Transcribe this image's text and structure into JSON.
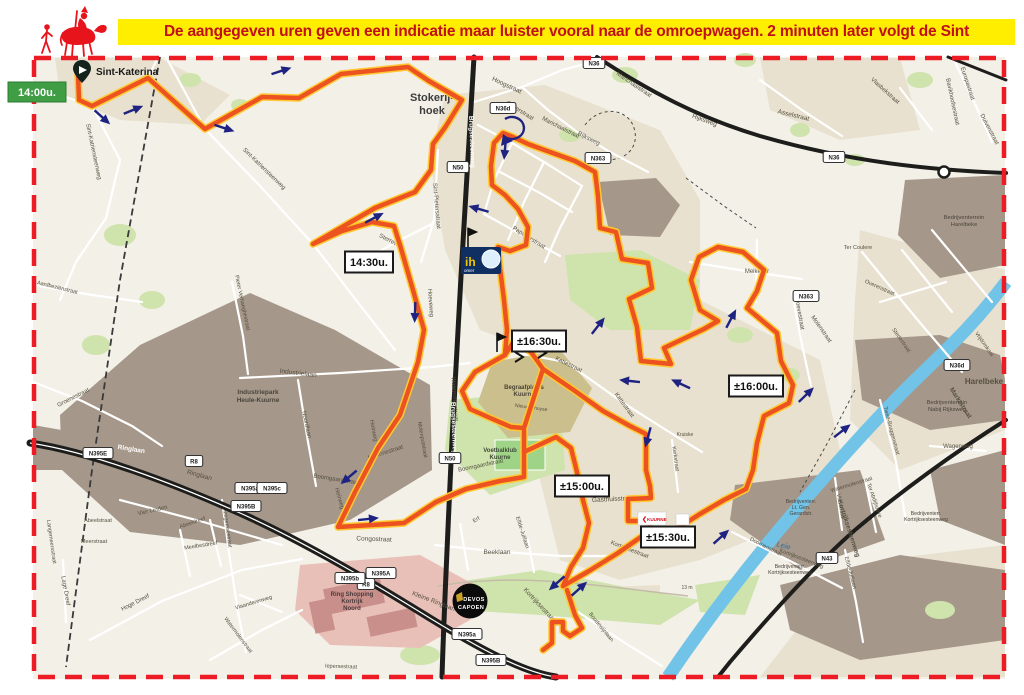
{
  "header": {
    "banner": "De aangegeven uren geven een indicatie maar luister vooral naar de omroepwagen. 2 minuten later volgt de Sint"
  },
  "palette": {
    "banner_bg": "#ffee00",
    "banner_text": "#c00f1a",
    "border": "#ed1c24",
    "map_bg": "#f3f0e8",
    "town": "#e9e1d0",
    "industry": "#a5978a",
    "green": "#cfe3ad",
    "field": "#9fd488",
    "cemetery": "#cbbf8e",
    "shopping": "#e9c0b8",
    "shop_building": "#c98f8a",
    "river": "#72c3e8",
    "black_road": "#1d1d1b",
    "white_road": "#ffffff",
    "route_casing": "#ffc933",
    "route_core": "#ec5320",
    "arrow": "#1e2382",
    "start_bg": "#3f9d44",
    "start_text": "#ffffff",
    "marker_bg": "#ffffff",
    "marker_border": "#1a1a1a",
    "marker_text": "#111111",
    "street_text": "#55503f"
  },
  "start": {
    "time": "14:00u.",
    "place": "Sint-Katerina"
  },
  "time_markers": [
    {
      "label": "14:30u.",
      "x": 369,
      "y": 262
    },
    {
      "label": "±16:30u.",
      "x": 539,
      "y": 341
    },
    {
      "label": "±16:00u.",
      "x": 756,
      "y": 386
    },
    {
      "label": "±15:00u.",
      "x": 582,
      "y": 486
    },
    {
      "label": "±15:30u.",
      "x": 668,
      "y": 537
    }
  ],
  "area_labels": [
    {
      "lines": [
        "Stokerij-",
        "hoek"
      ],
      "x": 432,
      "y": 101,
      "s": 11,
      "w": 1,
      "c": "#3d3d3d",
      "lh": 13
    },
    {
      "lines": [
        "Industriepark",
        "Heule-Kuurne"
      ],
      "x": 258,
      "y": 394,
      "s": 6.5,
      "w": 1,
      "c": "#4a443a",
      "lh": 8
    },
    {
      "lines": [
        "Bedrijventerrein",
        "Harelbeke"
      ],
      "x": 964,
      "y": 219,
      "s": 5.8,
      "c": "#4a443a",
      "lh": 7
    },
    {
      "lines": [
        "Bedrijventerrein",
        "Nabij Rijksweg"
      ],
      "x": 947,
      "y": 404,
      "s": 5.8,
      "c": "#4a443a",
      "lh": 7
    },
    {
      "lines": [
        "Begraafplaats",
        "Kuurne"
      ],
      "x": 524,
      "y": 389,
      "s": 6,
      "w": 1,
      "c": "#4a4434",
      "lh": 7
    },
    {
      "lines": [
        "Voetbalklub",
        "Kuurne"
      ],
      "x": 500,
      "y": 452,
      "s": 6,
      "w": 1,
      "c": "#3f4a38",
      "lh": 7
    },
    {
      "lines": [
        "Ring Shopping",
        "Kortrijk",
        "Noord"
      ],
      "x": 352,
      "y": 596,
      "s": 6,
      "w": 1,
      "c": "#4a3a3a",
      "lh": 7
    },
    {
      "lines": [
        "Bedrijventerr.",
        "Lt. Gen.",
        "Gerardstr."
      ],
      "x": 801,
      "y": 503,
      "s": 5.2,
      "c": "#4a443a",
      "lh": 6
    },
    {
      "lines": [
        "Bedrijventerr.",
        "Kortrijksesteenweg"
      ],
      "x": 790,
      "y": 568,
      "s": 5.2,
      "c": "#4a443a",
      "lh": 6
    },
    {
      "lines": [
        "Bedrijventerr.",
        "Kortrijksesteenweg"
      ],
      "x": 926,
      "y": 515,
      "s": 5.2,
      "c": "#4a443a",
      "lh": 6
    }
  ],
  "street_labels": [
    {
      "t": "Sint-Katriensteenweg",
      "x": 92,
      "y": 152,
      "r": 78,
      "s": 6
    },
    {
      "t": "Sint-Katriensteenweg",
      "x": 263,
      "y": 170,
      "r": 44,
      "s": 6
    },
    {
      "t": "Hoogstraat",
      "x": 506,
      "y": 87,
      "r": 25,
      "s": 6.5
    },
    {
      "t": "Gaverstraat",
      "x": 519,
      "y": 112,
      "r": 32,
      "s": 6
    },
    {
      "t": "Marichaalstraat",
      "x": 560,
      "y": 129,
      "r": 27,
      "s": 6
    },
    {
      "t": "Marichaalstraat",
      "x": 633,
      "y": 86,
      "r": 34,
      "s": 6
    },
    {
      "t": "Rijksweg",
      "x": 588,
      "y": 140,
      "r": 27,
      "s": 6
    },
    {
      "t": "Rijksweg",
      "x": 704,
      "y": 122,
      "r": 20,
      "s": 6.5
    },
    {
      "t": "Asselstraat",
      "x": 793,
      "y": 117,
      "r": 14,
      "s": 6.5
    },
    {
      "t": "Vlasbekstraat",
      "x": 884,
      "y": 92,
      "r": 42,
      "s": 6
    },
    {
      "t": "Europastraat",
      "x": 966,
      "y": 84,
      "r": 72,
      "s": 6
    },
    {
      "t": "Bavikhoofsestraat",
      "x": 951,
      "y": 102,
      "r": 78,
      "s": 6
    },
    {
      "t": "Duivenstraat",
      "x": 988,
      "y": 130,
      "r": 62,
      "s": 6
    },
    {
      "t": "Sint-Pietersstraat",
      "x": 435,
      "y": 206,
      "r": 85,
      "s": 6
    },
    {
      "t": "Sterreweg",
      "x": 391,
      "y": 243,
      "r": 27,
      "s": 6
    },
    {
      "t": "Hoeveweg",
      "x": 429,
      "y": 303,
      "r": 86,
      "s": 6
    },
    {
      "t": "Watertorenstraat",
      "x": 453,
      "y": 399,
      "r": 86,
      "s": 6
    },
    {
      "t": "Heirweg",
      "x": 372,
      "y": 431,
      "r": 79,
      "s": 6
    },
    {
      "t": "Heirweg",
      "x": 338,
      "y": 499,
      "r": 74,
      "s": 6
    },
    {
      "t": "Papaverstraat",
      "x": 528,
      "y": 239,
      "r": 32,
      "s": 6
    },
    {
      "t": "Kattestraat",
      "x": 568,
      "y": 366,
      "r": 26,
      "s": 6
    },
    {
      "t": "Kattestraat",
      "x": 623,
      "y": 406,
      "r": 54,
      "s": 6
    },
    {
      "t": "Meikever",
      "x": 757,
      "y": 273,
      "r": 0,
      "s": 6
    },
    {
      "t": "Hoevestraat",
      "x": 798,
      "y": 314,
      "r": 80,
      "s": 6
    },
    {
      "t": "Molenstraat",
      "x": 820,
      "y": 330,
      "r": 55,
      "s": 6
    },
    {
      "t": "Industrielaan",
      "x": 298,
      "y": 375,
      "r": 7,
      "s": 6.5
    },
    {
      "t": "Noordlaan",
      "x": 305,
      "y": 425,
      "r": 78,
      "s": 6
    },
    {
      "t": "Groenestraat",
      "x": 74,
      "y": 399,
      "r": -27,
      "s": 6
    },
    {
      "t": "Pieter Verhaeghestraat",
      "x": 241,
      "y": 303,
      "r": 78,
      "s": 5.5
    },
    {
      "t": "Aardbeziënstraat",
      "x": 57,
      "y": 289,
      "r": 14,
      "s": 5.5
    },
    {
      "t": "Ringlaan",
      "x": 131,
      "y": 451,
      "r": 9,
      "s": 6.5,
      "w": 1,
      "c": "#ffffff"
    },
    {
      "t": "Ringlaan",
      "x": 199,
      "y": 477,
      "r": 15,
      "s": 6.5
    },
    {
      "t": "Congostraat",
      "x": 374,
      "y": 541,
      "r": 2,
      "s": 6.5
    },
    {
      "t": "Morinnestraat",
      "x": 386,
      "y": 454,
      "r": -18,
      "s": 6
    },
    {
      "t": "Molenputstraat",
      "x": 421,
      "y": 440,
      "r": 80,
      "s": 5.5
    },
    {
      "t": "Boomgaardstraat",
      "x": 336,
      "y": 481,
      "r": 9,
      "s": 6
    },
    {
      "t": "Boomgaardstraat",
      "x": 481,
      "y": 467,
      "r": -12,
      "s": 6
    },
    {
      "t": "Gasthuisstraat",
      "x": 613,
      "y": 501,
      "r": -3,
      "s": 6.5
    },
    {
      "t": "Beeklaan",
      "x": 497,
      "y": 554,
      "r": 0,
      "s": 6.5
    },
    {
      "t": "Erf",
      "x": 477,
      "y": 521,
      "r": -30,
      "s": 5.5
    },
    {
      "t": "Elfde-Julilaan",
      "x": 521,
      "y": 533,
      "r": 72,
      "s": 5.5
    },
    {
      "t": "Elfde-Julilaan",
      "x": 849,
      "y": 573,
      "r": 75,
      "s": 5.5
    },
    {
      "t": "Kortrijksestraat",
      "x": 538,
      "y": 606,
      "r": 47,
      "s": 6.5
    },
    {
      "t": "Kortrijksestraat",
      "x": 629,
      "y": 551,
      "r": 21,
      "s": 6
    },
    {
      "t": "Boudewijnlaan",
      "x": 600,
      "y": 628,
      "r": 51,
      "s": 5.5
    },
    {
      "t": "Kerkstraat",
      "x": 674,
      "y": 459,
      "r": 82,
      "s": 5.5
    },
    {
      "t": "Kruiske",
      "x": 685,
      "y": 436,
      "r": 0,
      "s": 5
    },
    {
      "t": "Doornenstraat",
      "x": 765,
      "y": 548,
      "r": 27,
      "s": 5.5
    },
    {
      "t": "Kortrijksesteenweg",
      "x": 847,
      "y": 529,
      "r": 72,
      "s": 6.5,
      "w": 1
    },
    {
      "t": "Kortrijksesteenweg",
      "x": 801,
      "y": 560,
      "r": 21,
      "s": 5.5
    },
    {
      "t": "Watermolenstraat",
      "x": 852,
      "y": 486,
      "r": -17,
      "s": 5.5
    },
    {
      "t": "Watermolenstraat",
      "x": 237,
      "y": 636,
      "r": 53,
      "s": 5.5
    },
    {
      "t": "Vlasstraat",
      "x": 839,
      "y": 506,
      "r": 80,
      "s": 5.5
    },
    {
      "t": "Ter Abdijhoeve",
      "x": 873,
      "y": 501,
      "r": 71,
      "s": 5.5
    },
    {
      "t": "Twee-Bruggenstraat",
      "x": 890,
      "y": 431,
      "r": 75,
      "s": 5.5
    },
    {
      "t": "Marktstraat",
      "x": 959,
      "y": 404,
      "r": 57,
      "s": 6.5,
      "w": 1
    },
    {
      "t": "Wagenweg",
      "x": 958,
      "y": 448,
      "r": 0,
      "s": 6
    },
    {
      "t": "Vrijdomkaai",
      "x": 983,
      "y": 345,
      "r": 55,
      "s": 5.5
    },
    {
      "t": "Overenstraat",
      "x": 879,
      "y": 289,
      "r": 24,
      "s": 5.5
    },
    {
      "t": "Stedestraat",
      "x": 900,
      "y": 341,
      "r": 55,
      "s": 5.5
    },
    {
      "t": "Ter Coulere",
      "x": 858,
      "y": 249,
      "r": 0,
      "s": 5.5
    },
    {
      "t": "Leie",
      "x": 783,
      "y": 548,
      "r": 14,
      "s": 7.5,
      "c": "#2f6f9e",
      "i": 1
    },
    {
      "t": "13 m",
      "x": 687,
      "y": 589,
      "r": 0,
      "s": 5
    },
    {
      "t": "Vier Linden",
      "x": 153,
      "y": 512,
      "r": -13,
      "s": 6
    },
    {
      "t": "Abeeldreef",
      "x": 193,
      "y": 524,
      "r": -19,
      "s": 5.5
    },
    {
      "t": "Meelbesdreef",
      "x": 201,
      "y": 547,
      "r": -9,
      "s": 5.5
    },
    {
      "t": "Lage Dreef",
      "x": 64,
      "y": 591,
      "r": 80,
      "s": 6
    },
    {
      "t": "Hoge Dreef",
      "x": 136,
      "y": 604,
      "r": -27,
      "s": 6
    },
    {
      "t": "Izegemsestraat",
      "x": 226,
      "y": 529,
      "r": 82,
      "s": 5.5
    },
    {
      "t": "Langemeersstraat",
      "x": 50,
      "y": 542,
      "r": 82,
      "s": 5.5
    },
    {
      "t": "Abeelstraat",
      "x": 98,
      "y": 522,
      "r": 0,
      "s": 5.5
    },
    {
      "t": "Meerstraat",
      "x": 94,
      "y": 543,
      "r": 0,
      "s": 5.5
    },
    {
      "t": "Vlaanderenweg",
      "x": 254,
      "y": 604,
      "r": -17,
      "s": 5.5
    },
    {
      "t": "Iepersestraat",
      "x": 341,
      "y": 668,
      "r": 2,
      "s": 5.5
    },
    {
      "t": "Kleine Ringlaan",
      "x": 433,
      "y": 603,
      "r": 21,
      "s": 6.5
    },
    {
      "t": "Brugsesteenweg",
      "x": 470,
      "y": 142,
      "r": 88,
      "s": 6.5,
      "c": "#ffffff",
      "w": 1
    },
    {
      "t": "Brugsesteenweg",
      "x": 452,
      "y": 428,
      "r": 88,
      "s": 6.5,
      "c": "#ffffff",
      "w": 1
    },
    {
      "t": "Nieuwenhuyse",
      "x": 531,
      "y": 409,
      "r": 8,
      "s": 5
    },
    {
      "t": "Harelbeke",
      "x": 984,
      "y": 384,
      "r": 0,
      "s": 8,
      "w": 1
    }
  ],
  "shields": [
    {
      "t": "N50",
      "x": 458,
      "y": 167
    },
    {
      "t": "N50",
      "x": 450,
      "y": 458
    },
    {
      "t": "N36d",
      "x": 503,
      "y": 108
    },
    {
      "t": "N36",
      "x": 594,
      "y": 63
    },
    {
      "t": "N363",
      "x": 598,
      "y": 158
    },
    {
      "t": "N363",
      "x": 806,
      "y": 296
    },
    {
      "t": "N36",
      "x": 834,
      "y": 157
    },
    {
      "t": "N36d",
      "x": 957,
      "y": 365
    },
    {
      "t": "N395E",
      "x": 98,
      "y": 453
    },
    {
      "t": "R8",
      "x": 194,
      "y": 461
    },
    {
      "t": "R8",
      "x": 366,
      "y": 584
    },
    {
      "t": "N395a",
      "x": 250,
      "y": 488
    },
    {
      "t": "N395c",
      "x": 272,
      "y": 488
    },
    {
      "t": "N395B",
      "x": 246,
      "y": 506
    },
    {
      "t": "N395A",
      "x": 381,
      "y": 573
    },
    {
      "t": "N395b",
      "x": 350,
      "y": 578
    },
    {
      "t": "N395a",
      "x": 467,
      "y": 634
    },
    {
      "t": "N395B",
      "x": 491,
      "y": 660
    },
    {
      "t": "N43",
      "x": 827,
      "y": 558
    }
  ],
  "route": {
    "segments": [
      "78,74 79,100 92,106 148,78 205,129 262,97 299,98 341,74 408,67 429,81 462,100 446,126 433,144 431,170 415,192 375,208 313,244 342,231 372,222 394,226 400,245 413,290 424,330 418,362 400,415 378,448 355,492 338,527 372,525 404,523 436,502 466,489 500,481 524,477 524,430",
      "524,452 556,437 571,448 576,468 583,500 589,523 583,548 571,567 563,586",
      "563,586 589,571 618,553 648,532 658,543 678,528 700,514 724,500 746,489",
      "646,470 650,486 651,498 628,499 628,521 650,521 651,545 657,542",
      "746,489 753,470 757,443 764,416 789,403 793,385 781,361 777,333 747,308 757,291 764,270 743,252 718,247 699,257 691,280 700,310 718,321 704,329 664,348 671,364 641,361 637,327 629,299 652,288 648,263 622,259 616,232 600,228 598,196 595,172 575,161 550,152 528,144 513,137 503,133 494,143 491,166 492,185 505,195 518,209 528,227 526,245 510,251 498,247 500,268 504,300 507,330 505,355",
      "505,355 475,372 462,391 470,409 488,417 511,427 524,428 543,369 531,352 514,341 505,355",
      "543,369 575,391 603,411 630,426 646,434 646,470",
      "567,590 575,615 582,628 570,636 563,631 563,622 552,622 552,643 543,650"
    ]
  },
  "arrows": [
    {
      "x": 102,
      "y": 117,
      "r": 42
    },
    {
      "x": 133,
      "y": 110,
      "r": -22
    },
    {
      "x": 224,
      "y": 128,
      "r": 18
    },
    {
      "x": 281,
      "y": 71,
      "r": -18
    },
    {
      "x": 374,
      "y": 218,
      "r": -28
    },
    {
      "x": 415,
      "y": 312,
      "r": 92
    },
    {
      "x": 349,
      "y": 477,
      "r": 140
    },
    {
      "x": 368,
      "y": 519,
      "r": -6
    },
    {
      "x": 505,
      "y": 149,
      "r": 95
    },
    {
      "x": 479,
      "y": 209,
      "r": 196
    },
    {
      "x": 598,
      "y": 326,
      "r": -52
    },
    {
      "x": 681,
      "y": 384,
      "r": 205
    },
    {
      "x": 806,
      "y": 395,
      "r": -44
    },
    {
      "x": 731,
      "y": 319,
      "r": -62
    },
    {
      "x": 721,
      "y": 537,
      "r": -42
    },
    {
      "x": 842,
      "y": 431,
      "r": -38
    },
    {
      "x": 557,
      "y": 583,
      "r": 138
    },
    {
      "x": 579,
      "y": 589,
      "r": -42
    },
    {
      "x": 648,
      "y": 437,
      "r": 105
    },
    {
      "x": 630,
      "y": 381,
      "r": 186
    }
  ],
  "logos": {
    "devos": {
      "line1": "DEVOS",
      "line2": "CAPOEN"
    },
    "kuurne": {
      "mark": "❮",
      "text": "KUURNE"
    },
    "ih": {
      "text": "ih",
      "sub": "omer"
    }
  }
}
